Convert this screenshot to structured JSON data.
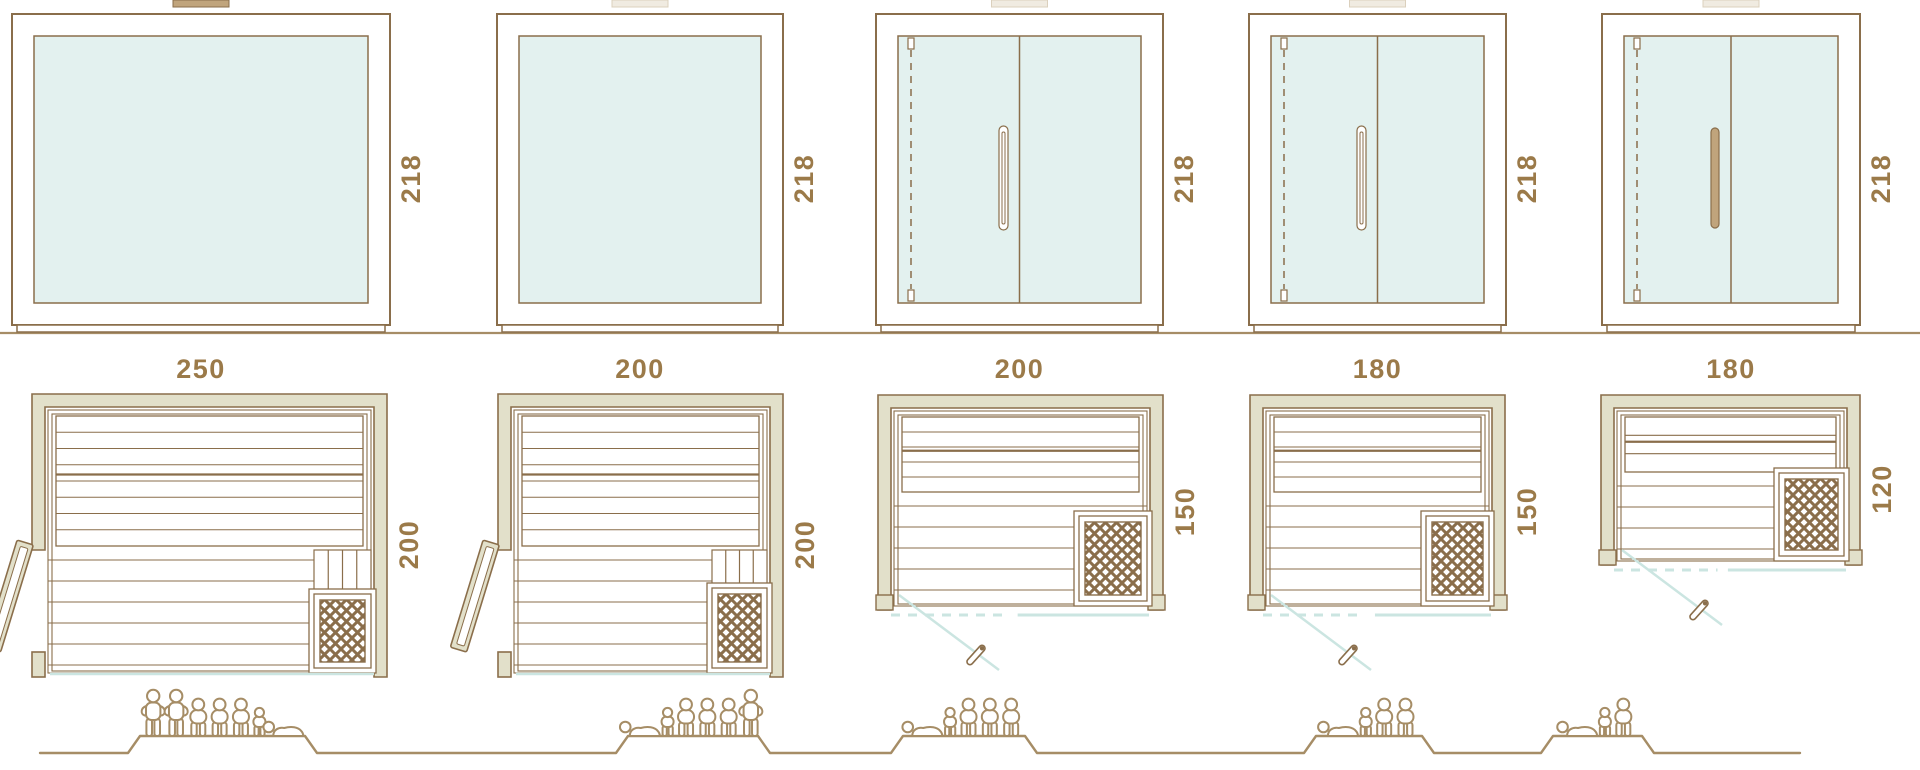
{
  "diagram_title": "sauna-cabin-size-comparison",
  "colors": {
    "outline": "#8a6e4b",
    "wall": "#e2e0ca",
    "glass": "#e3f1ef",
    "teal": "#cbe5e1",
    "tan": "#c0a47c",
    "cap_light": "#f0ebe1",
    "cap_light_border": "#dbd0bd",
    "text": "#9b7a49",
    "people": "#a68d66",
    "white": "#ffffff"
  },
  "modules": [
    {
      "name": "sauna-250x200",
      "elevation": {
        "width": "250",
        "height": "218",
        "front": "fixed-glass",
        "handle": "none"
      },
      "plan": {
        "depth": "200",
        "door": "hinged-leaf-open-left",
        "heater": "bottom-right"
      },
      "people": [
        "standing",
        "standing",
        "seated",
        "seated",
        "seated",
        "child",
        "lying"
      ]
    },
    {
      "name": "sauna-200x200",
      "elevation": {
        "width": "200",
        "height": "218",
        "front": "fixed-glass",
        "handle": "none"
      },
      "plan": {
        "depth": "200",
        "door": "hinged-leaf-open-left",
        "heater": "bottom-right"
      },
      "people": [
        "lying",
        "child",
        "seated",
        "seated",
        "seated",
        "standing"
      ]
    },
    {
      "name": "sauna-200x150",
      "elevation": {
        "width": "200",
        "height": "218",
        "front": "glass-double-door",
        "handle": "outline"
      },
      "plan": {
        "depth": "150",
        "door": "swing-front",
        "heater": "bottom-right"
      },
      "people": [
        "lying",
        "child",
        "seated",
        "seated",
        "seated"
      ]
    },
    {
      "name": "sauna-180x150",
      "elevation": {
        "width": "180",
        "height": "218",
        "front": "glass-double-door",
        "handle": "outline"
      },
      "plan": {
        "depth": "150",
        "door": "swing-front",
        "heater": "bottom-right"
      },
      "people": [
        "lying",
        "child",
        "seated",
        "seated"
      ]
    },
    {
      "name": "sauna-180x120",
      "elevation": {
        "width": "180",
        "height": "218",
        "front": "glass-double-door",
        "handle": "filled"
      },
      "plan": {
        "depth": "120",
        "door": "swing-front",
        "heater": "right"
      },
      "people": [
        "lying",
        "child",
        "seated"
      ]
    }
  ]
}
